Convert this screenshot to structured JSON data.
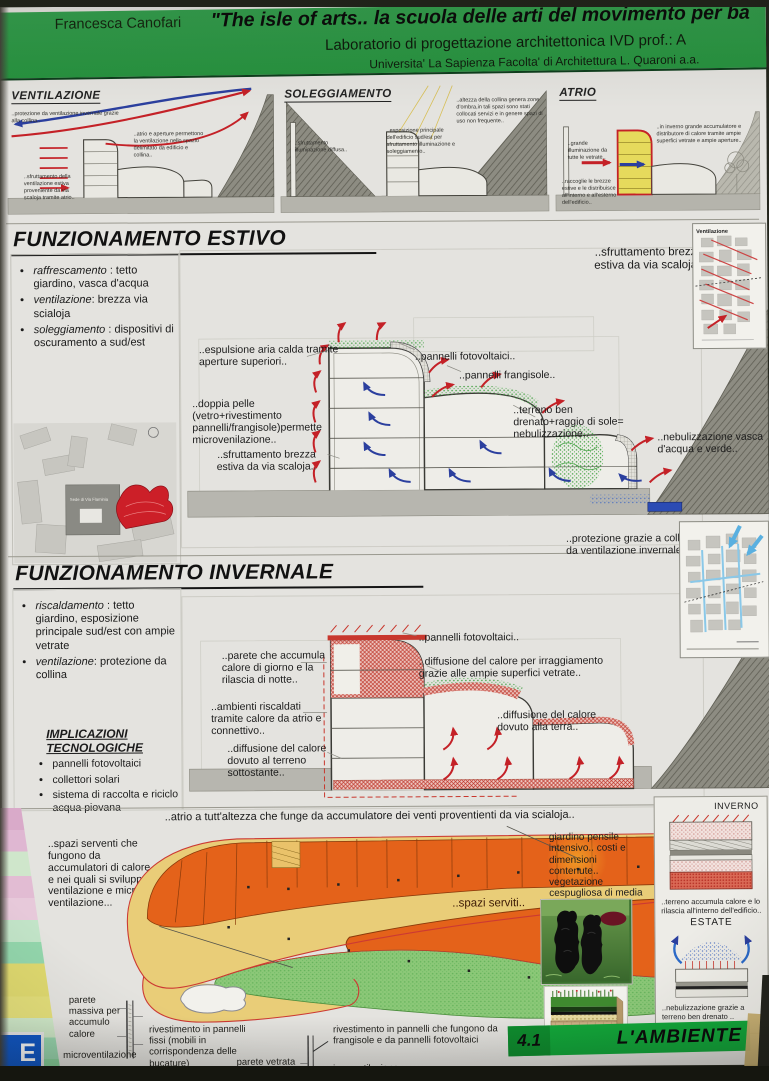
{
  "header": {
    "author": "Francesca Canofari",
    "title": "\"The isle of arts.. la scuola delle arti del movimento per ba",
    "course": "Laboratorio di progettazione architettonica IVD   prof.: A",
    "university": "Universita' La Sapienza  Facolta' di Architettura L. Quaroni  a.a."
  },
  "top_diagrams": {
    "ventilazione": {
      "title": "VENTILAZIONE",
      "note_left": "..protezione da ventilazione invernale grazie alla collina..",
      "note_center": "..atrio e aperture permettono la ventilazione nello spazio delimitato da edificio e collina..",
      "note_bottom": "..sfruttamento della ventilazione estiva proveniente da via scaloja tramite atrio.."
    },
    "soleggiamento": {
      "title": "SOLEGGIAMENTO",
      "note_left": "..sfruttamento illuminazione diffusa..",
      "note_center": "..esposizione principale dell'edificio sud/est per sfruttamento illuminazione e soleggiamento..",
      "note_right": "..altezza della collina genera zone d'ombra,in tali spazi sono stati collocati servizi e in genere spazi di uso non frequente.."
    },
    "atrio": {
      "title": "ATRIO",
      "note_left": "..grande illuminazione da tutte le vetrate..",
      "note_right": "..in inverno grande accumulatore e distributore di calore tramite ampie superfici vetrate e ampie aperture..",
      "note_bottom": "..raccoglie le brezze estive e le distribuisce all'interno e all'esterno dell'edificio.."
    }
  },
  "estivo": {
    "title": "FUNZIONAMENTO ESTIVO",
    "bullets": [
      {
        "term": "raffrescamento",
        "rest": " : tetto giardino, vasca d'acqua"
      },
      {
        "term": "ventilazione",
        "rest": ": brezza via scialoja"
      },
      {
        "term": "soleggiamento",
        "rest": " : dispositivi di oscuramento a sud/est"
      }
    ],
    "map_label": "Sede di Via Flaminia",
    "note_top_right": "..sfruttamento brezza estiva da via scaloja..",
    "mini_map_title": "Ventilazione",
    "ann_espulsione": "..espulsione aria calda tramite aperture superiori..",
    "ann_fotovoltaici": "..pannelli fotovoltaici..",
    "ann_frangisole": "..pannelli frangisole..",
    "ann_doppia_pelle": "..doppia pelle (vetro+rivestimento pannelli/frangisole)permette microvenilazione..",
    "ann_terreno": "..terreno ben drenato+raggio di sole= nebulizzazione..",
    "ann_brezza": "..sfruttamento brezza estiva da via scaloja..",
    "ann_nebulizzazione": "..nebulizzazione vasca d'acqua e verde.."
  },
  "invernale": {
    "title": "FUNZIONAMENTO INVERNALE",
    "bullets": [
      {
        "term": "riscaldamento",
        "rest": " : tetto giardino, esposizione principale sud/est con ampie vetrate"
      },
      {
        "term": "ventilazione",
        "rest": ": protezione da collina"
      }
    ],
    "implicazioni_title": "IMPLICAZIONI TECNOLOGICHE",
    "implicazioni": [
      "pannelli fotovoltaici",
      "collettori solari",
      "sistema di raccolta e riciclo acqua piovana"
    ],
    "note_top_right": "..protezione grazie a collina da ventilazione invernale..",
    "ann_fotovoltaici": "..pannelli fotovoltaici..",
    "ann_parete": "..parete che accumula calore di giorno e la rilascia di notte..",
    "ann_diffusione_vetrate": "..diffusione del calore per irraggiamento grazie alle ampie superfici vetrate..",
    "ann_ambienti": "..ambienti riscaldati tramite calore da atrio e connettivo..",
    "ann_diffusione_terra": "..diffusione del calore dovuto alla terra..",
    "ann_diffusione_terreno": "..diffusione del calore dovuto al terreno sottostante.."
  },
  "plan": {
    "ann_atrio": "..atrio a tutt'altezza che funge da accumulatore dei venti proventienti da via scialoja..",
    "ann_spazi_serventi": "..spazi serventi che fungono da accumulatori di calore e nei quali si sviluppa ventilazione e micro ventilazione...",
    "ann_spazi_serviti": "..spazi serviti..",
    "ann_giardino": "giardino pensile intensivo.. costi e dimensioni contenute.. vegetazione cespugliosa di media grandezza",
    "wall_left": {
      "parete": "parete massiva per accumulo calore",
      "micro": "microventilazione",
      "rivestimento": "rivestimento in pannelli fissi (mobili in corrispondenza delle bucature)"
    },
    "wall_right": {
      "vetrata": "parete vetrata",
      "rivestimento": "rivestimento in pannelli che fungono da frangisole e da pannelli fotovoltaici",
      "micro": "microventilazione"
    }
  },
  "seasons_box": {
    "inverno_label": "INVERNO",
    "inverno_caption": "..terreno accumula calore e lo rilascia all'interno dell'edificio..",
    "estate_label": "ESTATE",
    "estate_caption": "..nebulizzazione grazie a terreno ben drenato .."
  },
  "footer": {
    "number": "4.1",
    "label": "L'AMBIENTE"
  },
  "corner_logo": "E",
  "colors": {
    "banner_green": "#2f9b48",
    "footer_green": "#12a73a",
    "accent_red": "#c42127",
    "accent_blue": "#2b3f9e",
    "plan_orange": "#e4621a",
    "plan_yellow": "#e9cd78",
    "plan_green": "#8cc878"
  }
}
